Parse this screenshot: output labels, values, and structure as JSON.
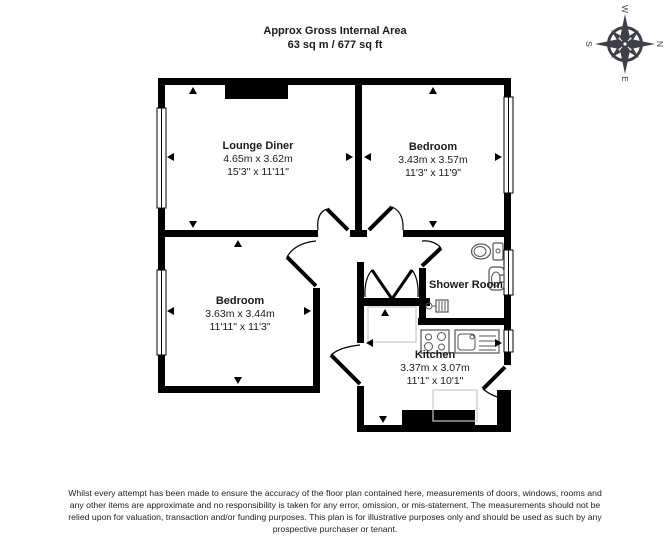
{
  "header": {
    "title_line1": "Approx Gross Internal Area",
    "title_line2": "63 sq m / 677 sq ft"
  },
  "compass": {
    "north": "N",
    "east": "E",
    "south": "S",
    "west": "W"
  },
  "rooms": [
    {
      "id": "lounge-diner",
      "name": "Lounge Diner",
      "size_metric": "4.65m x 3.62m",
      "size_imperial": "15'3\" x 11'11\""
    },
    {
      "id": "bedroom-1",
      "name": "Bedroom",
      "size_metric": "3.43m x 3.57m",
      "size_imperial": "11'3\" x 11'9\""
    },
    {
      "id": "bedroom-2",
      "name": "Bedroom",
      "size_metric": "3.63m x 3.44m",
      "size_imperial": "11'11\" x 11'3\""
    },
    {
      "id": "shower-room",
      "name": "Shower Room",
      "size_metric": "",
      "size_imperial": ""
    },
    {
      "id": "kitchen",
      "name": "Kitchen",
      "size_metric": "3.37m x 3.07m",
      "size_imperial": "11'1\" x 10'1\""
    }
  ],
  "disclaimer": {
    "line1": "Whilst every attempt has been made to ensure the accuracy of the floor plan contained here, measurements of doors, windows, rooms and",
    "line2": "any other items are approximate and no responsibility is taken for any error, omission, or mis-statement. The measurements should not be",
    "line3": "relied upon for valuation, transaction and/or funding purposes. This plan is for illustrative purposes only and should be used as such by any",
    "line4": "prospective purchaser or tenant."
  },
  "colors": {
    "wall": "#000000",
    "compass": "#3f3f48",
    "counter_outline": "#c9c9c9",
    "background": "#ffffff"
  }
}
